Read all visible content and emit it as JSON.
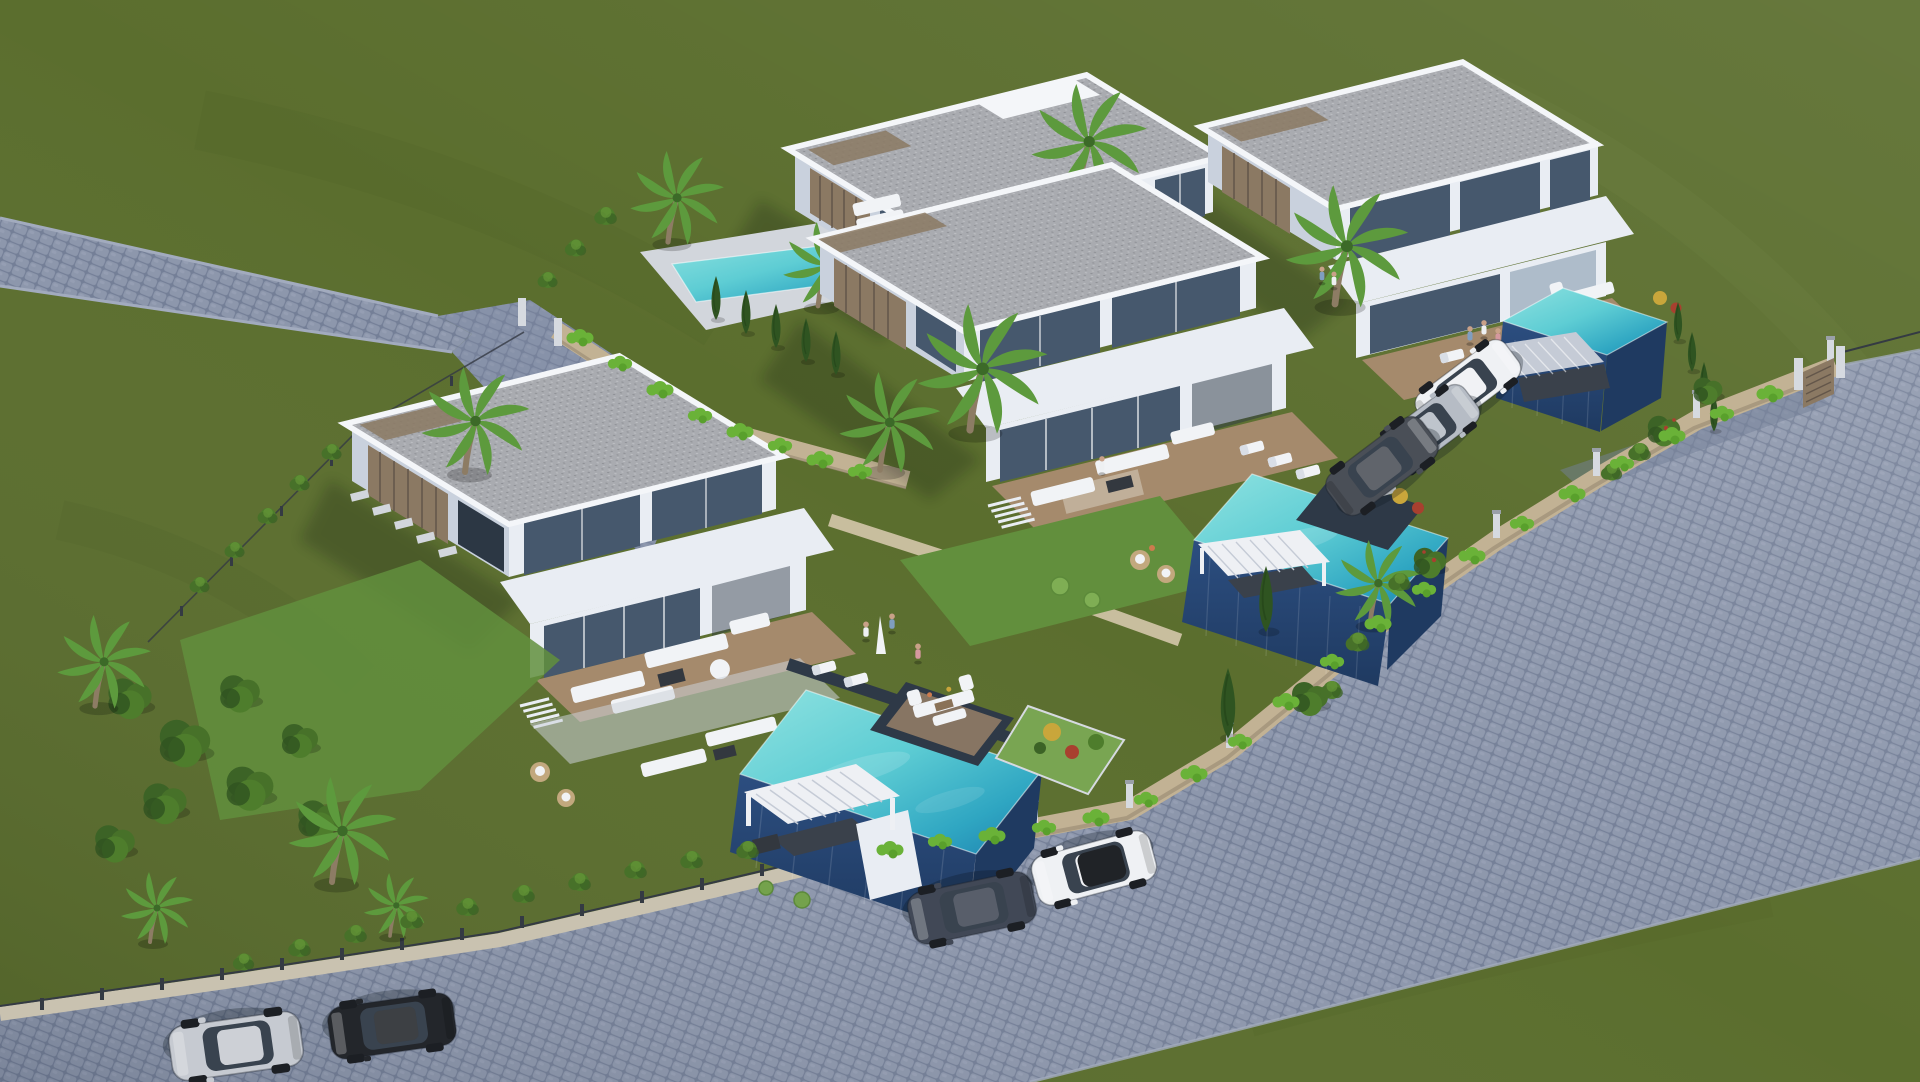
{
  "scene": {
    "title": "Aerial 3D architectural rendering — modern villa development",
    "environment": "hillside plot with four white modern villas, turquoise infinity pools, cobblestone roads and olive-green fields",
    "villa_count": 4,
    "pool_count": 4,
    "car_count": 7,
    "people_count": 9
  },
  "villas": [
    {
      "id": "villa-top",
      "position": "top center",
      "storeys": 2,
      "pool": "deck-level turquoise pool with steps",
      "extras": [
        "sun loungers",
        "outdoor sofa",
        "cypress row",
        "palm trees"
      ]
    },
    {
      "id": "villa-right",
      "position": "upper right",
      "storeys": 2,
      "pool": "elevated navy infinity pool",
      "extras": [
        "grey louvered pergola",
        "entrance gate",
        "fruit garden",
        "terrace with people"
      ]
    },
    {
      "id": "villa-middle",
      "position": "center",
      "storeys": 2,
      "pool": "elevated navy infinity pool with sunken lounge",
      "extras": [
        "white pergola",
        "cactus garden",
        "rattan lounge",
        "stairs"
      ]
    },
    {
      "id": "villa-front",
      "position": "lower left",
      "storeys": 2,
      "pool": "elevated navy infinity pool with sunken lounge",
      "extras": [
        "white pergola with bar",
        "cobbled driveway",
        "stepping stones",
        "cacti",
        "tree garden"
      ]
    }
  ],
  "roads": {
    "left_road": "narrow cobblestone lane entering from upper left",
    "main_road": "wide cobblestone road wrapping the right and bottom of the plot",
    "driveway": "cobbled driveway from the lane to the front villa"
  },
  "cars": [
    {
      "id": "car-white-coupe",
      "color_name": "white",
      "hex": "#eff1f4",
      "style": "--carBody:#eff1f4",
      "location": "right road, upper"
    },
    {
      "id": "car-silver-sedan",
      "color_name": "silver",
      "hex": "#b6bcc5",
      "style": "--carBody:#b6bcc5",
      "location": "right road, middle"
    },
    {
      "id": "car-dark-suv",
      "color_name": "dark grey",
      "hex": "#4a4f57",
      "style": "--carBody:#4a4f57",
      "location": "right road, lower"
    },
    {
      "id": "car-navy-sedan",
      "color_name": "dark blue-grey",
      "hex": "#414856",
      "style": "--carBody:#414856",
      "location": "bottom road, left"
    },
    {
      "id": "car-white-hatchback",
      "color_name": "white with black roof",
      "hex": "#eff1f4",
      "style": "--carBody:#eff1f4",
      "location": "bottom road, right"
    },
    {
      "id": "car-silver-sports",
      "color_name": "silver",
      "hex": "#c6cad1",
      "style": "--carBody:#c6cad1",
      "location": "lower-left road"
    },
    {
      "id": "car-black-coupe",
      "color_name": "black",
      "hex": "#23262b",
      "style": "--carBody:#23262b",
      "location": "lower-left road"
    }
  ],
  "colors": {
    "grass": "#5b6e2e",
    "grassLight": "#6a7d3c",
    "grassDark": "#4c5e25",
    "grassStreak": "#76894a",
    "road": "#8d97ac",
    "roadLight": "#a2abbe",
    "roadDark": "#747f97",
    "curb": "#c9c2b0",
    "driveway": "#7f8aa2",
    "wallStone": "#c2b294",
    "wallStoneLight": "#d4c6ab",
    "wallShadow": "#8e8069",
    "ivy": "#6ab238",
    "hedge": "#4e7d2c",
    "bush": "#477129",
    "treeDark": "#3c6326",
    "cypress": "#2f5421",
    "palmFrond": "#5d9a3d",
    "palmTrunk": "#8d7c64",
    "lawn": "#628f3d",
    "lawnLight": "#79a552",
    "facade": "#e9edf3",
    "facadeShade": "#c9d1dd",
    "parapet": "#f4f6f9",
    "roofGravel": "#a9abb0",
    "roofDot": "#c2c4c8",
    "wood": "#8b7963",
    "woodDark": "#63564a",
    "deck": "#a58a6c",
    "deckDark": "#8a7258",
    "stone": "#d2d6dc",
    "glass": "#46586d",
    "glassLight": "#7d93a8",
    "frame": "#2c3744",
    "poolAqua": "#5ecdd4",
    "poolLight": "#8fe2e0",
    "poolMid": "#2fa6c2",
    "poolDeep": "#1d7fae",
    "poolWall": "#2c4e80",
    "poolWallDark": "#1f3a61",
    "poolTile": "#2e3947",
    "pergola": "#eef0f4",
    "pergolaShadow": "#c5cbd6",
    "pergolaDark": "#3a414b",
    "furniture": "#f1f3f6",
    "furnitureShade": "#d4d9e1",
    "rattan": "#c2a87e",
    "tableDark": "#33383f",
    "fence": "#343a43",
    "post": "#d6dae0",
    "skin": "#c9a188",
    "shirtBlue": "#7f9ec0",
    "shirtPink": "#d5989f",
    "shirtWhite": "#eef0f2",
    "accentRed": "#a8402f",
    "accentYellow": "#c9a63b",
    "accentOrange": "#cc7b4e",
    "wheel": "#1c1f24",
    "carGlass": "#39434f",
    "carWhite": "#eff1f4",
    "carSilver": "#b6bcc5",
    "carDark": "#4a4f57",
    "carNavy": "#414856",
    "carBlack": "#23262b",
    "carSports": "#c6cad1"
  }
}
